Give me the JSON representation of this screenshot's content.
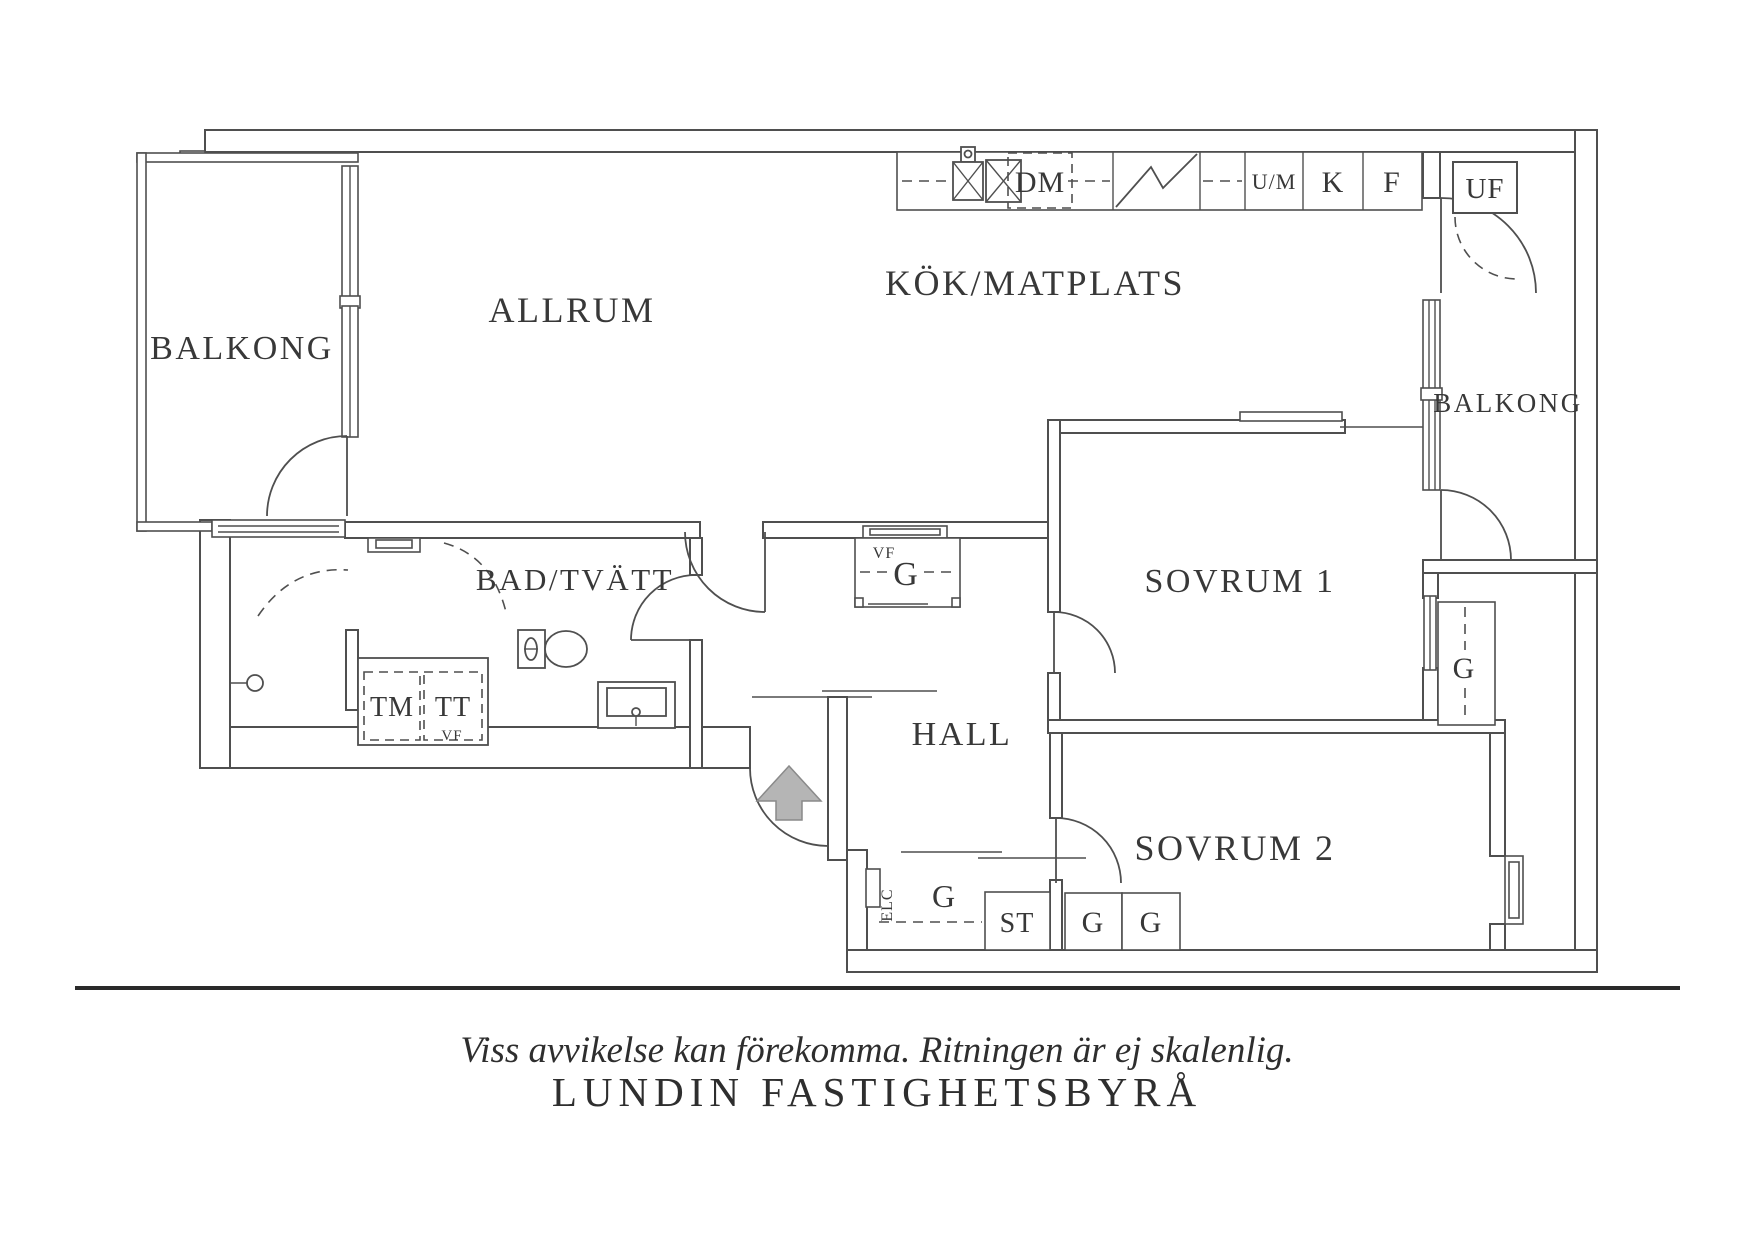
{
  "colors": {
    "line": "#4f4f4f",
    "text": "#383838",
    "arrow_fill": "#b5b5b5",
    "arrow_stroke": "#8a8a8a"
  },
  "plan": {
    "rooms": {
      "balcony_left": "BALKONG",
      "livingroom": "ALLRUM",
      "kitchen": "KÖK/MATPLATS",
      "balcony_right": "BALKONG",
      "bathroom": "BAD/TVÄTT",
      "hall": "HALL",
      "bedroom1": "SOVRUM 1",
      "bedroom2": "SOVRUM 2"
    },
    "kitchen_units": {
      "dishwasher": "DM",
      "oven_microwave": "U/M",
      "fridge": "K",
      "freezer": "F",
      "outdoor_storage": "UF"
    },
    "laundry": {
      "washing_machine": "TM",
      "tumble_dryer": "TT",
      "vf": "VF"
    },
    "hall_closet": {
      "vf": "VF",
      "g": "G"
    },
    "storage": {
      "electrical": "ELC",
      "corridor_g": "G",
      "cleaning": "ST",
      "bedroom2_g1": "G",
      "bedroom2_g2": "G",
      "bedroom1_g": "G"
    },
    "footer": {
      "disclaimer": "Viss avvikelse kan förekomma. Ritningen är ej skalenlig.",
      "brand": "LUNDIN FASTIGHETSBYRÅ"
    }
  }
}
